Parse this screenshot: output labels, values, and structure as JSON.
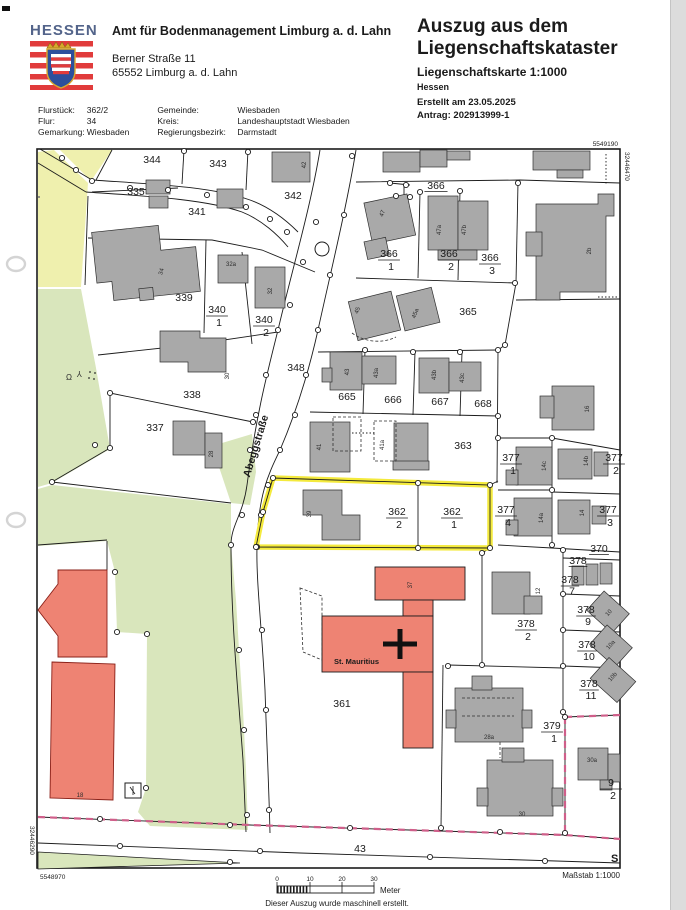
{
  "header": {
    "logo_text": "HESSEN",
    "office_name": "Amt für Bodenmanagement Limburg a. d. Lahn",
    "office_street": "Berner Straße 11",
    "office_city": "65552 Limburg a. d. Lahn",
    "title_line1": "Auszug aus dem",
    "title_line2": "Liegenschaftskataster",
    "subtitle": "Liegenschaftskarte 1:1000",
    "state": "Hessen",
    "created": "Erstellt am 23.05.2025",
    "request": "Antrag: 202913999-1"
  },
  "info": {
    "flurstueck_label": "Flurstück:",
    "flurstueck": "362/2",
    "flur_label": "Flur:",
    "flur": "34",
    "gemarkung_label": "Gemarkung:",
    "gemarkung": "Wiesbaden",
    "gemeinde_label": "Gemeinde:",
    "gemeinde": "Wiesbaden",
    "kreis_label": "Kreis:",
    "kreis": "Landeshauptstadt Wiesbaden",
    "regbez_label": "Regierungsbezirk:",
    "regbez": "Darmstadt"
  },
  "map": {
    "street_name": "Abeggstraße",
    "church_name": "St. Mauritius",
    "corner_coords": {
      "top_right_northing": "5549190",
      "right_easting": "32446470",
      "left_easting": "32446290",
      "bottom_left_northing": "5548970"
    },
    "parcel_labels": [
      {
        "t": "344",
        "x": 152,
        "y": 163
      },
      {
        "t": "343",
        "x": 218,
        "y": 167
      },
      {
        "t": "342",
        "x": 293,
        "y": 199
      },
      {
        "t": "335",
        "x": 136,
        "y": 195
      },
      {
        "t": "341",
        "x": 197,
        "y": 215
      },
      {
        "t": "339",
        "x": 184,
        "y": 301
      },
      {
        "t": "338",
        "x": 192,
        "y": 398
      },
      {
        "t": "337",
        "x": 155,
        "y": 431
      },
      {
        "t": "348",
        "x": 296,
        "y": 371
      },
      {
        "t": "366",
        "x": 436,
        "y": 189,
        "ul": true
      },
      {
        "t": "365",
        "x": 468,
        "y": 315
      },
      {
        "t": "665",
        "x": 347,
        "y": 400
      },
      {
        "t": "666",
        "x": 393,
        "y": 403
      },
      {
        "t": "667",
        "x": 440,
        "y": 405
      },
      {
        "t": "668",
        "x": 483,
        "y": 407
      },
      {
        "t": "363",
        "x": 463,
        "y": 449
      },
      {
        "t": "370",
        "x": 599,
        "y": 552,
        "ul": true,
        "s": 9
      },
      {
        "t": "378",
        "x": 578,
        "y": 564,
        "ul": true,
        "s": 8.5
      },
      {
        "t": "361",
        "x": 342,
        "y": 707
      },
      {
        "t": "43",
        "x": 360,
        "y": 852
      }
    ],
    "fraction_labels": [
      {
        "n": "340",
        "d": "1",
        "x": 217,
        "y": 313
      },
      {
        "n": "340",
        "d": "2",
        "x": 264,
        "y": 323
      },
      {
        "n": "366",
        "d": "1",
        "x": 389,
        "y": 257
      },
      {
        "n": "366",
        "d": "2",
        "x": 449,
        "y": 257
      },
      {
        "n": "366",
        "d": "3",
        "x": 490,
        "y": 261
      },
      {
        "n": "362",
        "d": "2",
        "x": 397,
        "y": 515
      },
      {
        "n": "362",
        "d": "1",
        "x": 452,
        "y": 515
      },
      {
        "n": "377",
        "d": "1",
        "x": 511,
        "y": 461
      },
      {
        "n": "377",
        "d": "2",
        "x": 614,
        "y": 461
      },
      {
        "n": "377",
        "d": "4",
        "x": 506,
        "y": 513
      },
      {
        "n": "377",
        "d": "3",
        "x": 608,
        "y": 513
      },
      {
        "n": "378",
        "d": "7",
        "x": 570,
        "y": 583,
        "s": 8
      },
      {
        "n": "378",
        "d": "9",
        "x": 586,
        "y": 613,
        "s": 8.5
      },
      {
        "n": "378",
        "d": "10",
        "x": 587,
        "y": 648,
        "s": 8.5
      },
      {
        "n": "378",
        "d": "11",
        "x": 589,
        "y": 687,
        "s": 8.5
      },
      {
        "n": "378",
        "d": "2",
        "x": 526,
        "y": 627
      },
      {
        "n": "379",
        "d": "1",
        "x": 552,
        "y": 729
      },
      {
        "n": "9",
        "d": "2",
        "x": 611,
        "y": 786
      }
    ],
    "building_labels": [
      {
        "t": "42",
        "x": 306,
        "y": 165,
        "r": -90
      },
      {
        "t": "47",
        "x": 384,
        "y": 214,
        "r": -70
      },
      {
        "t": "47a",
        "x": 441,
        "y": 230,
        "r": -90
      },
      {
        "t": "47b",
        "x": 466,
        "y": 230,
        "r": -90
      },
      {
        "t": "2b",
        "x": 591,
        "y": 251,
        "r": -90
      },
      {
        "t": "45",
        "x": 359,
        "y": 311,
        "r": -70
      },
      {
        "t": "45a",
        "x": 417,
        "y": 314,
        "r": -70
      },
      {
        "t": "34",
        "x": 163,
        "y": 272,
        "r": -75
      },
      {
        "t": "32a",
        "x": 231,
        "y": 266,
        "r": 0
      },
      {
        "t": "32",
        "x": 272,
        "y": 291,
        "r": -90
      },
      {
        "t": "30",
        "x": 229,
        "y": 376,
        "r": -90
      },
      {
        "t": "28",
        "x": 213,
        "y": 454,
        "r": -90
      },
      {
        "t": "43",
        "x": 349,
        "y": 372,
        "r": -90
      },
      {
        "t": "43a",
        "x": 378,
        "y": 373,
        "r": -90
      },
      {
        "t": "43b",
        "x": 436,
        "y": 375,
        "r": -90
      },
      {
        "t": "43c",
        "x": 464,
        "y": 378,
        "r": -90
      },
      {
        "t": "41",
        "x": 321,
        "y": 447,
        "r": -90
      },
      {
        "t": "41a",
        "x": 384,
        "y": 445,
        "r": -90
      },
      {
        "t": "39",
        "x": 311,
        "y": 514,
        "r": -90
      },
      {
        "t": "37",
        "x": 412,
        "y": 585,
        "r": -90
      },
      {
        "t": "12",
        "x": 540,
        "y": 591,
        "r": -90
      },
      {
        "t": "16",
        "x": 589,
        "y": 409,
        "r": -90
      },
      {
        "t": "14c",
        "x": 546,
        "y": 466,
        "r": -90
      },
      {
        "t": "14b",
        "x": 588,
        "y": 461,
        "r": -90
      },
      {
        "t": "14a",
        "x": 543,
        "y": 518,
        "r": -90
      },
      {
        "t": "14",
        "x": 584,
        "y": 513,
        "r": -90
      },
      {
        "t": "10",
        "x": 610,
        "y": 614,
        "r": -48
      },
      {
        "t": "10a",
        "x": 612,
        "y": 646,
        "r": -48
      },
      {
        "t": "10b",
        "x": 614,
        "y": 678,
        "r": -48
      },
      {
        "t": "28a",
        "x": 489,
        "y": 739,
        "r": 0
      },
      {
        "t": "30",
        "x": 522,
        "y": 816,
        "r": 0
      },
      {
        "t": "30a",
        "x": 592,
        "y": 762,
        "r": 0
      },
      {
        "t": "18",
        "x": 80,
        "y": 797,
        "r": 0
      }
    ]
  },
  "footer": {
    "scale_ticks": [
      "0",
      "10",
      "20",
      "30"
    ],
    "meter_label": "Meter",
    "masstab": "Maßstab 1:1000",
    "disclaimer": "Dieser Auszug wurde maschinell erstellt.",
    "s_label": "S"
  },
  "colors": {
    "highlight_yellow": "#f4ea3d",
    "area_green": "#d9e6bc",
    "area_pale_yellow": "#eff0ae",
    "building_gray": "#a9a9a9",
    "building_red": "#ee8373",
    "boundary_pink": "#cf5f8a",
    "hessen_blue": "#53648a",
    "flag_red": "#e13b3b"
  }
}
